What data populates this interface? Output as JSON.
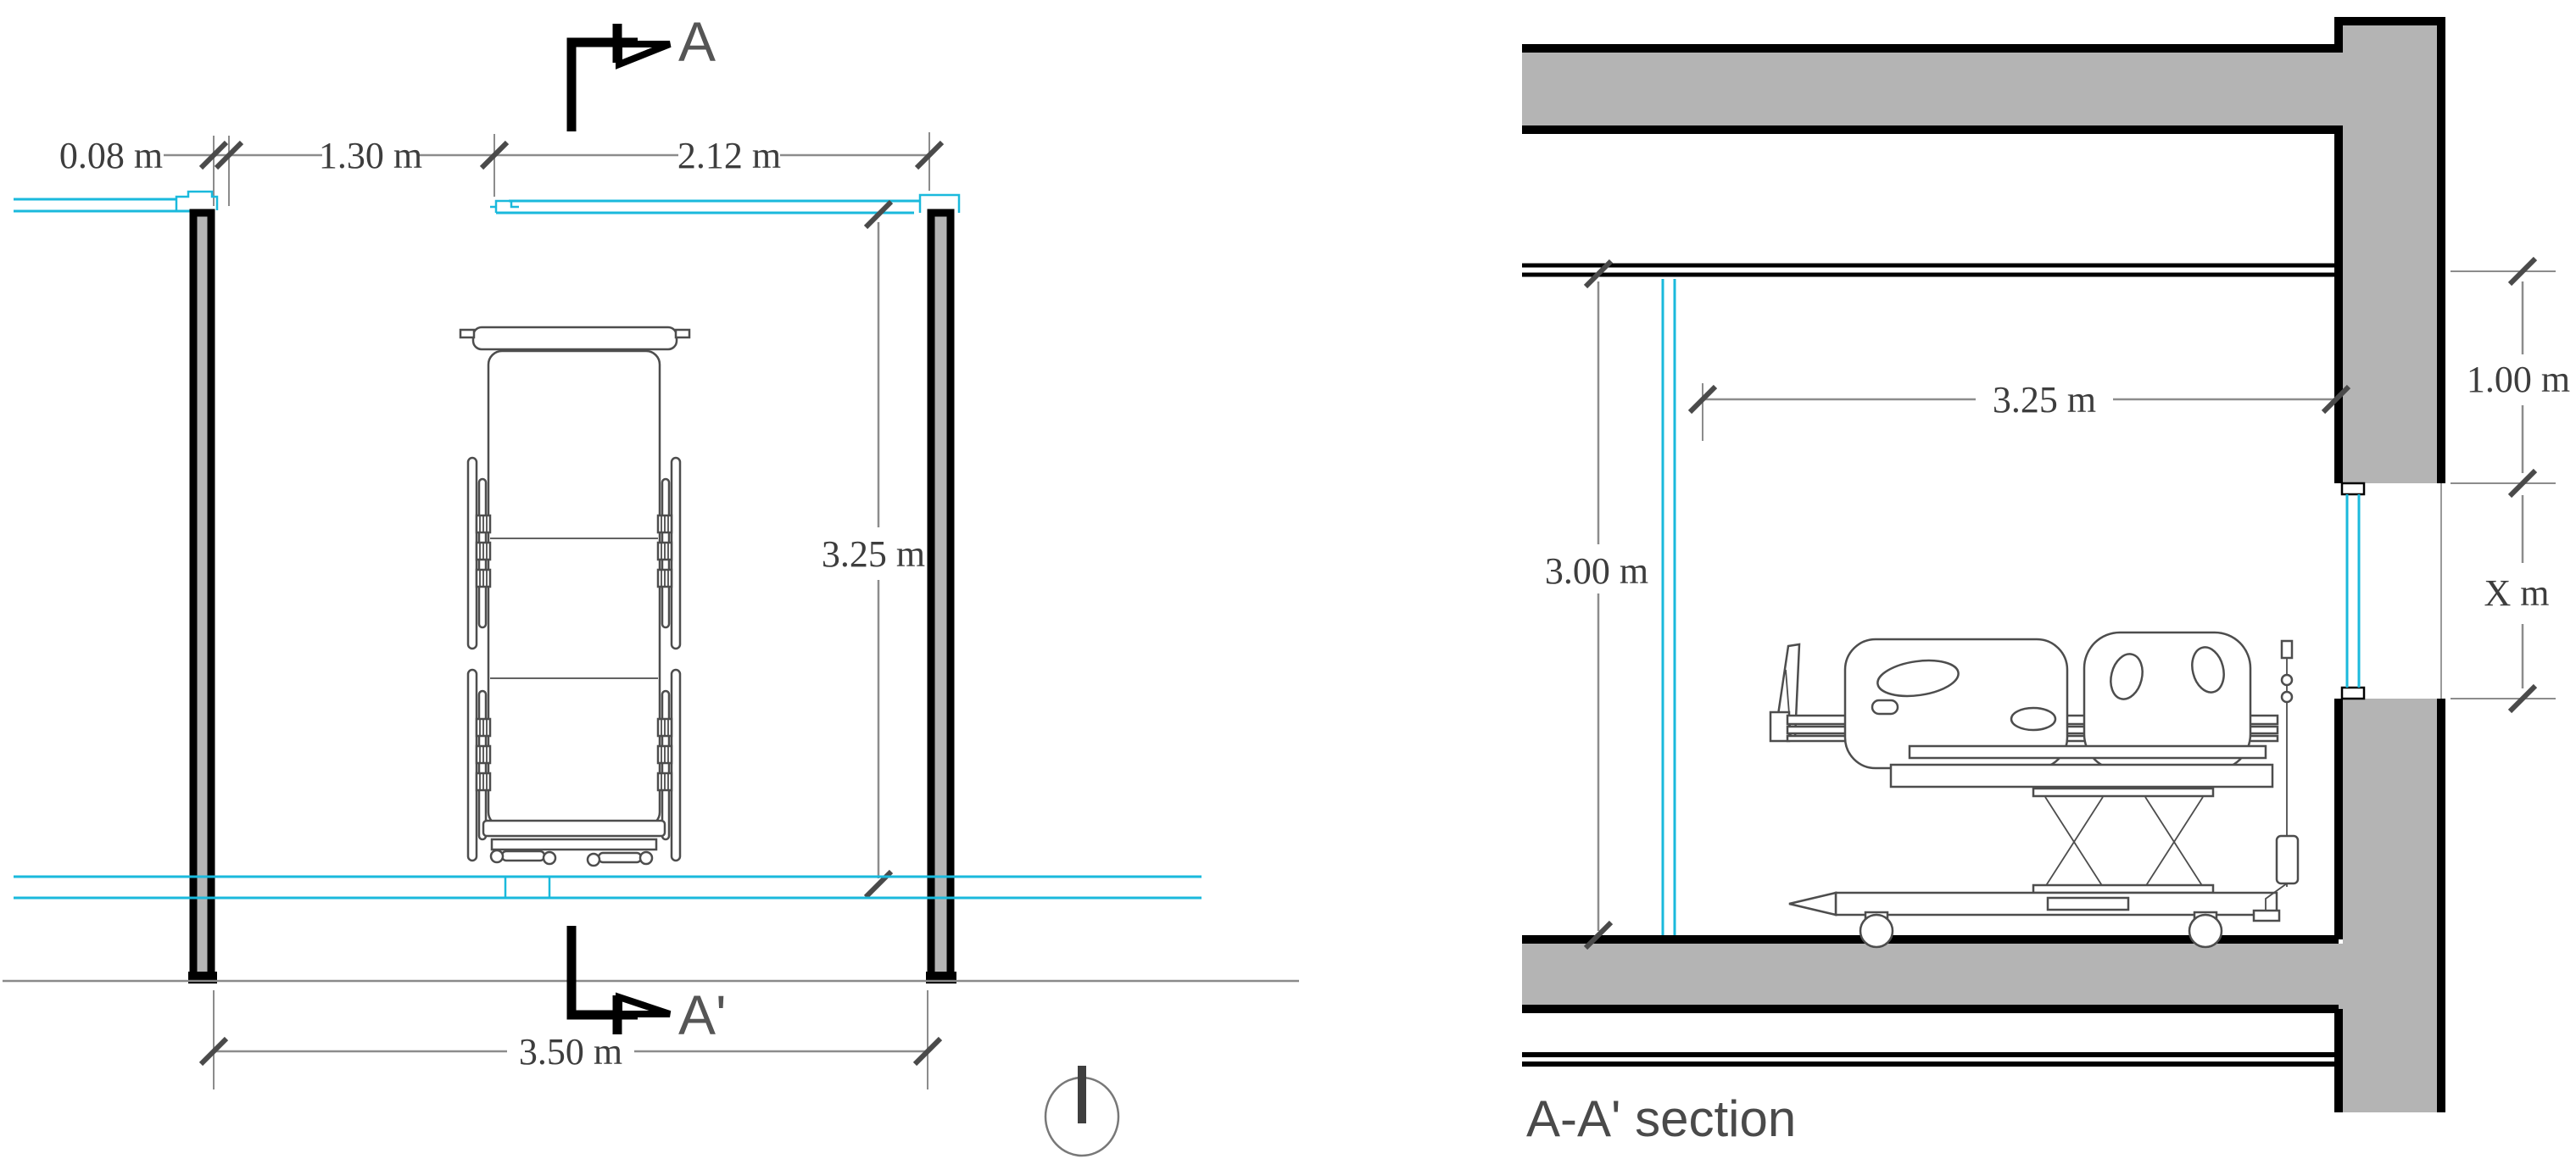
{
  "colors": {
    "cyan_accent": "#1ab9dc",
    "wall_fill": "#b4b4b4",
    "outline": "#000000",
    "dimension_line": "#8c8c8c",
    "dimension_text": "#3d3d3d",
    "marker_text": "#555555",
    "title_text": "#4a4a4a"
  },
  "plan": {
    "section_marker_start": "A",
    "section_marker_end": "A'",
    "dims": {
      "wall_offset": "0.08 m",
      "left_span": "1.30 m",
      "window_span": "2.12 m",
      "room_depth": "3.25 m",
      "room_width": "3.50 m"
    }
  },
  "section": {
    "title": "A-A' section",
    "dims": {
      "clear_height": "3.00 m",
      "room_width": "3.25 m",
      "above_opening": "1.00 m",
      "opening_height": "X m"
    }
  }
}
